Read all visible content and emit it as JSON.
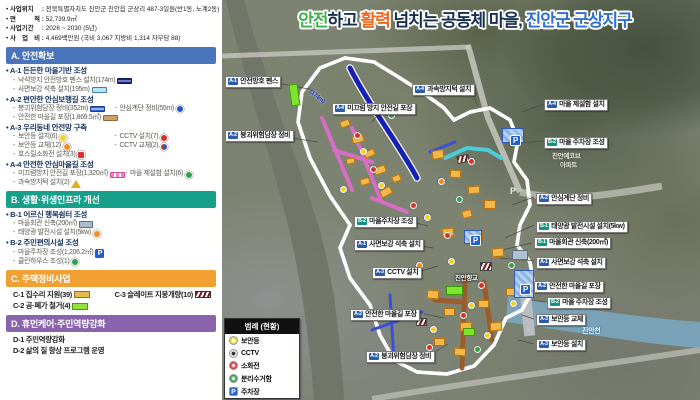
{
  "project_info": [
    {
      "label": "사업위치",
      "value": "전북특별자치도 진안군 진안읍 군상리 487-3일원(반1동, 노계2동)"
    },
    {
      "label": "면 적",
      "value": "52,739.9㎡"
    },
    {
      "label": "사업기간",
      "value": "2026 ~ 2030 (5년)"
    },
    {
      "label": "사 업 비",
      "value": "4,469백만원 (국비 3,067  지방비 1,314  자부담 88)"
    }
  ],
  "title": {
    "segments": [
      {
        "text": "안전",
        "color": "#3db14b"
      },
      {
        "text": "하고 ",
        "color": "#17304e"
      },
      {
        "text": "활력",
        "color": "#f2661e"
      },
      {
        "text": " 넘치는 공동체 마을, ",
        "color": "#17304e"
      },
      {
        "text": "진안군 군상지구",
        "color": "#2e6fd2"
      }
    ]
  },
  "sections": [
    {
      "id": "A",
      "label": "A. 안전확보",
      "color": "#4a74bc",
      "groups": [
        {
          "title": "A-1 든든한 마을기반 조성",
          "rows": [
            [
              {
                "text": "낙석방지 안전방호 펜스 설치(174m)",
                "icon": "fence-bar"
              }
            ],
            [
              {
                "text": "사면보강 석축 설치(195m)",
                "icon": "stone-bar"
              }
            ]
          ]
        },
        {
          "title": "A-2 편안한 안심보행길 조성",
          "rows": [
            [
              {
                "text": "붕괴위험담장 정비(352m)",
                "icon": "wall-bar"
              },
              {
                "text": "안심계단 정비(55m)",
                "icon": "stair"
              }
            ],
            [
              {
                "text": "안전한 마을길 포장(1,869.5㎡)",
                "icon": "pave-bar"
              }
            ]
          ]
        },
        {
          "title": "A-3 우리동네 안전망 구축",
          "rows": [
            [
              {
                "text": "보안등 설치(6)",
                "icon": "light-new"
              },
              {
                "text": "CCTV 설치(7)",
                "icon": "cctv-new"
              }
            ],
            [
              {
                "text": "보안등 교체(12)",
                "icon": "light-replace"
              },
              {
                "text": "CCTV 교체(2)",
                "icon": "cctv-replace"
              }
            ],
            [
              {
                "text": "호스릴소화전 설치(3)",
                "icon": "hydrant"
              }
            ]
          ]
        },
        {
          "title": "A-4 안전한 안심마을길 조성",
          "rows": [
            [
              {
                "text": "미끄럼방지 안전길 포장(1,320㎡)",
                "icon": "slip-bar"
              },
              {
                "text": "마을 제설함 설치(6)",
                "icon": "snowbox"
              }
            ],
            [
              {
                "text": "과속방지턱 설치(2)",
                "icon": "speedbump"
              }
            ]
          ]
        }
      ]
    },
    {
      "id": "B",
      "label": "B. 생활·위생인프라 개선",
      "color": "#16a08c",
      "groups": [
        {
          "title": "B-1 어르신 행복쉼터 조성",
          "rows": [
            [
              {
                "text": "마을회관 신축(200㎡)",
                "icon": "hall"
              }
            ],
            [
              {
                "text": "태양광 발전시설 설치(5kw)",
                "icon": "solar"
              }
            ]
          ]
        },
        {
          "title": "B-2 주민편의시설 조성",
          "rows": [
            [
              {
                "text": "마을주차장 조성(1,206.2㎡)",
                "icon": "parking"
              }
            ],
            [
              {
                "text": "클린하우스 조성(1)",
                "icon": "cleanhouse"
              }
            ]
          ]
        }
      ]
    },
    {
      "id": "C",
      "label": "C. 주택정비사업",
      "color": "#f2a032",
      "groups": [
        {
          "title": null,
          "rows": [
            [
              {
                "text": "C-1 집수리 지원(39)",
                "icon": "c1",
                "plain": true
              },
              {
                "text": "C-3 슬레이트 지붕개량(10)",
                "icon": "c3",
                "plain": true
              }
            ],
            [
              {
                "text": "C-2 공·폐가 철거(4)",
                "icon": "c2",
                "plain": true
              }
            ]
          ]
        }
      ]
    },
    {
      "id": "D",
      "label": "D. 휴먼케어·주민역량강화",
      "color": "#8a63ad",
      "groups": [
        {
          "title": null,
          "rows": [
            [
              {
                "text": "D-1 주민역량강화",
                "plain": true
              }
            ],
            [
              {
                "text": "D-2 삶의 질 향상 프로그램 운영",
                "plain": true
              }
            ]
          ]
        }
      ]
    }
  ],
  "legend": {
    "title": "범례 (현황)",
    "items": [
      {
        "label": "보안등",
        "icon": "security-light"
      },
      {
        "label": "CCTV",
        "icon": "cctv"
      },
      {
        "label": "소화전",
        "icon": "hydrant"
      },
      {
        "label": "분리수거함",
        "icon": "recycle-bin"
      },
      {
        "label": "주차장",
        "icon": "parking"
      }
    ]
  },
  "map": {
    "badge_colors": {
      "A": "#2b5ca8",
      "B": "#12927f"
    },
    "labels": [
      {
        "badge": "A-1",
        "text": "안전방호 펜스",
        "x": 3,
        "y": 76
      },
      {
        "badge": "A-2",
        "text": "붕괴위험담장 정비",
        "x": 3,
        "y": 130
      },
      {
        "badge": "A-4",
        "text": "미끄럼 방지 안전길 포장",
        "x": 110,
        "y": 103
      },
      {
        "badge": "A-4",
        "text": "과속방지턱 설치",
        "x": 190,
        "y": 84
      },
      {
        "badge": "A-4",
        "text": "마을 제설함 설치",
        "x": 322,
        "y": 99
      },
      {
        "badge": "B-2",
        "text": "마을 주차장 조성",
        "x": 322,
        "y": 137
      },
      {
        "badge": "A-2",
        "text": "안심계단 정비",
        "x": 314,
        "y": 193
      },
      {
        "badge": "B-1",
        "text": "태양광 발전시설 설치(5kw)",
        "x": 314,
        "y": 221
      },
      {
        "badge": "B-1",
        "text": "마을회관 신축(200㎡)",
        "x": 312,
        "y": 237
      },
      {
        "badge": "A-1",
        "text": "사면보강 석축 설치",
        "x": 314,
        "y": 257
      },
      {
        "badge": "B-2",
        "text": "마을주차장 조성",
        "x": 132,
        "y": 216
      },
      {
        "badge": "A-1",
        "text": "사면보강 석축 설치",
        "x": 132,
        "y": 239
      },
      {
        "badge": "A-3",
        "text": "CCTV 설치",
        "x": 150,
        "y": 267
      },
      {
        "badge": "A-2",
        "text": "안전한 마을길 포장",
        "x": 128,
        "y": 309
      },
      {
        "badge": "A-2",
        "text": "붕괴위험담장 정비",
        "x": 144,
        "y": 351
      },
      {
        "badge": "A-2",
        "text": "안전한 마을길 포장",
        "x": 312,
        "y": 281
      },
      {
        "badge": "B-2",
        "text": "마을 주차장 조성",
        "x": 325,
        "y": 297
      },
      {
        "badge": "A-3",
        "text": "보안등 교체",
        "x": 314,
        "y": 314
      },
      {
        "badge": "A-3",
        "text": "보안등 설치",
        "x": 314,
        "y": 339
      }
    ],
    "bg_labels": [
      {
        "text": "진안향교",
        "x": 233,
        "y": 272,
        "style": "place"
      },
      {
        "text": "진안예코브",
        "x": 330,
        "y": 150,
        "style": "apt"
      },
      {
        "text": "아파트",
        "x": 338,
        "y": 159,
        "style": "apt"
      },
      {
        "text": "진안천",
        "x": 360,
        "y": 326,
        "style": "river"
      },
      {
        "text": "(174m)",
        "x": 86,
        "y": 94,
        "style": "measure"
      },
      {
        "text": "P",
        "x": 288,
        "y": 186,
        "style": "road-p"
      }
    ],
    "icons": [
      {
        "type": "light",
        "x": 138,
        "y": 148
      },
      {
        "type": "light",
        "x": 156,
        "y": 182
      },
      {
        "type": "light",
        "x": 202,
        "y": 214
      },
      {
        "type": "light",
        "x": 226,
        "y": 258
      },
      {
        "type": "light",
        "x": 246,
        "y": 302
      },
      {
        "type": "light",
        "x": 262,
        "y": 332
      },
      {
        "type": "light",
        "x": 208,
        "y": 326
      },
      {
        "type": "light",
        "x": 118,
        "y": 186
      },
      {
        "type": "light",
        "x": 288,
        "y": 300
      },
      {
        "type": "cctv",
        "x": 148,
        "y": 166
      },
      {
        "type": "cctv",
        "x": 188,
        "y": 202
      },
      {
        "type": "cctv",
        "x": 222,
        "y": 232
      },
      {
        "type": "cctv",
        "x": 238,
        "y": 312
      },
      {
        "type": "cctv",
        "x": 204,
        "y": 344
      },
      {
        "type": "cctv",
        "x": 256,
        "y": 282
      },
      {
        "type": "cctv",
        "x": 132,
        "y": 132
      },
      {
        "type": "cctv",
        "x": 246,
        "y": 158
      },
      {
        "type": "green",
        "x": 166,
        "y": 112
      },
      {
        "type": "green",
        "x": 234,
        "y": 196
      },
      {
        "type": "green",
        "x": 252,
        "y": 346
      },
      {
        "type": "green",
        "x": 286,
        "y": 262
      },
      {
        "type": "orange",
        "x": 194,
        "y": 262
      },
      {
        "type": "orange",
        "x": 216,
        "y": 178
      }
    ],
    "parking_marks": [
      {
        "x": 288,
        "y": 135
      },
      {
        "x": 248,
        "y": 235
      },
      {
        "x": 298,
        "y": 284
      }
    ]
  }
}
